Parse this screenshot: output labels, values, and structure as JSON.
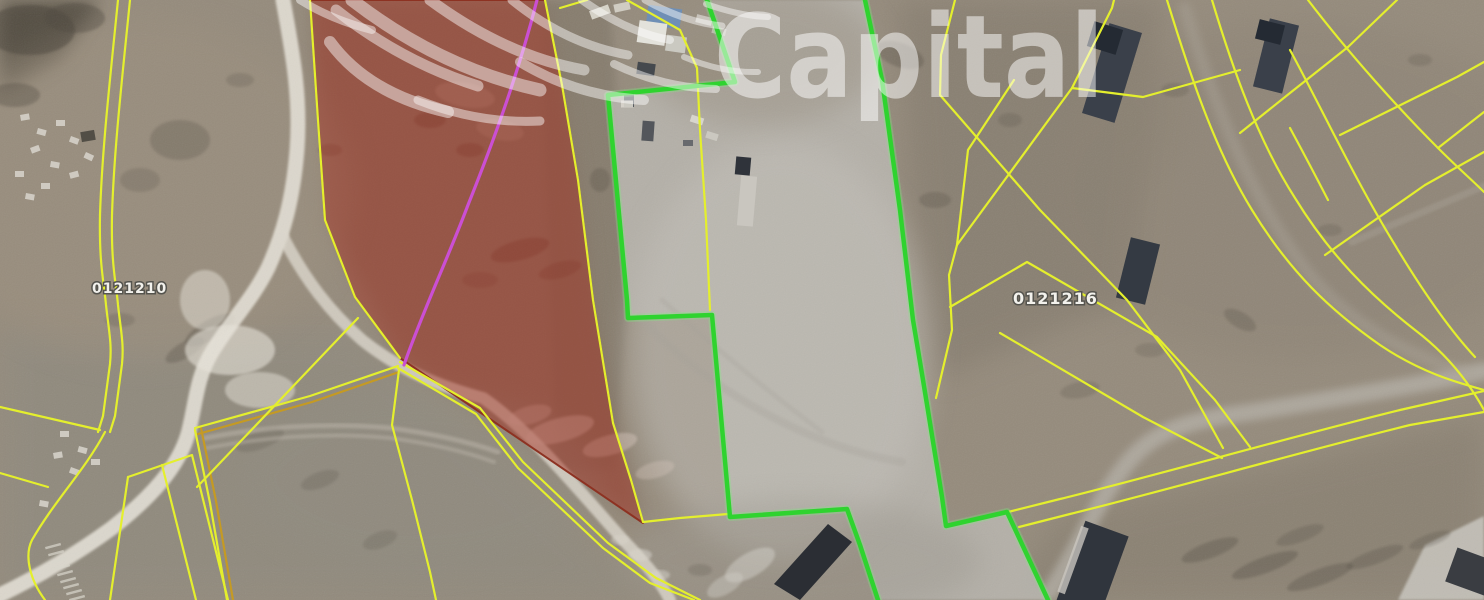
{
  "watermark": {
    "text": "Capital"
  },
  "labels": {
    "parcel_left": "0121210",
    "parcel_right": "0121216"
  },
  "colors": {
    "parcel_line_yellow": "#e4ef2d",
    "parcel_line_orange": "#c59a23",
    "selected_parcel_green": "#2fd32f",
    "selected_parcel_glow": "#7ef07e",
    "highlight_red_fill": "rgba(163,44,30,0.47)",
    "highlight_red_border": "#8d3222",
    "survey_line_magenta": "#cb4fd3",
    "road_light": "#e9e5db",
    "terrain_base": "#958b7c",
    "concrete_pad": "#b9b6af",
    "watermark_white": "rgba(255,255,255,0.55)"
  },
  "map": {
    "base": {
      "w": 1484,
      "h": 600,
      "fill": "#958b7c"
    },
    "patches": [
      {
        "pts": "0,0 100,0 62,58 0,95",
        "c": "#4f483c",
        "o": 0.8,
        "f": "b10"
      },
      {
        "pts": "0,330 360,330 660,600 0,600",
        "c": "#8e8a7f",
        "o": 0.6,
        "f": "b16"
      },
      {
        "pts": "540,0 610,0 628,300 614,470 556,470",
        "c": "#7e7566",
        "o": 0.6,
        "f": "b5"
      },
      {
        "pts": "898,0 1162,0 1130,300 938,378 918,300",
        "c": "#7f7669",
        "o": 0.5,
        "f": "b16"
      },
      {
        "pts": "1000,600 1062,518 1484,418 1484,600",
        "c": "#847b6d",
        "o": 0.55,
        "f": "b16"
      },
      {
        "pts": "310,0 545,0 578,180 593,300 643,523 400,358 325,220",
        "c": "#83705f",
        "o": 0.6,
        "f": "b10"
      },
      {
        "pts": "1398,600 1425,545 1484,516 1484,600",
        "c": "#c6c3bb",
        "o": 0.9,
        "f": "b2"
      }
    ],
    "pad_fill": [
      {
        "d": "M707,0 L865,0 L882,80 L900,210 L913,320 L923,380 L942,497 L946,526 L1007,512 L1048,600 L878,600 L860,545 L847,509 L730,517 L712,315 L628,318 L627,300 L608,95 L735,82 Z",
        "f": "#b9b6af",
        "o": 0.88
      }
    ],
    "soft_spots": [
      [
        140,
        190,
        210,
        170,
        0,
        "#9b8f7e",
        0.5
      ],
      [
        780,
        350,
        150,
        210,
        0,
        "#c3c0b9",
        0.5
      ],
      [
        760,
        55,
        120,
        70,
        0,
        "#9a9183",
        0.5
      ],
      [
        1300,
        190,
        260,
        170,
        0,
        "#8b8173",
        0.4
      ],
      [
        800,
        560,
        180,
        60,
        0,
        "#9c988f",
        0.45
      ],
      [
        420,
        480,
        180,
        90,
        0,
        "#908c81",
        0.4
      ],
      [
        1090,
        120,
        90,
        70,
        0,
        "#8a8172",
        0.35
      ]
    ],
    "dark_spots": [
      [
        30,
        30,
        45,
        25,
        0,
        "#4d463c",
        0.55
      ],
      [
        75,
        18,
        30,
        15,
        0,
        "#4d463c",
        0.4
      ],
      [
        15,
        95,
        25,
        12,
        0,
        "#4d463c",
        0.35
      ],
      [
        180,
        140,
        30,
        20,
        0,
        "#4d463c",
        0.25
      ],
      [
        140,
        180,
        20,
        12,
        0,
        "#4d463c",
        0.2
      ],
      [
        120,
        320,
        15,
        7,
        0,
        "#4d463c",
        0.2
      ],
      [
        210,
        330,
        28,
        10,
        -30,
        "#4d463c",
        0.35
      ],
      [
        185,
        350,
        22,
        8,
        -30,
        "#4d463c",
        0.3
      ],
      [
        240,
        80,
        14,
        7,
        0,
        "#4d463c",
        0.2
      ],
      [
        330,
        150,
        12,
        6,
        0,
        "#5a3227",
        0.22
      ],
      [
        430,
        120,
        16,
        8,
        0,
        "#5a3227",
        0.3
      ],
      [
        470,
        150,
        14,
        7,
        0,
        "#5a3227",
        0.28
      ],
      [
        520,
        250,
        30,
        10,
        -15,
        "#5f352a",
        0.32
      ],
      [
        560,
        270,
        22,
        8,
        -15,
        "#5f352a",
        0.25
      ],
      [
        480,
        280,
        18,
        8,
        0,
        "#5f352a",
        0.2
      ],
      [
        600,
        180,
        10,
        12,
        0,
        "#4a4238",
        0.25
      ],
      [
        900,
        55,
        25,
        12,
        20,
        "#4d463c",
        0.3
      ],
      [
        935,
        200,
        16,
        8,
        0,
        "#4d463c",
        0.25
      ],
      [
        1010,
        120,
        12,
        7,
        0,
        "#4d463c",
        0.2
      ],
      [
        1175,
        90,
        14,
        7,
        0,
        "#4d463c",
        0.2
      ],
      [
        1240,
        320,
        18,
        8,
        30,
        "#4d463c",
        0.25
      ],
      [
        1330,
        230,
        12,
        6,
        0,
        "#4d463c",
        0.2
      ],
      [
        1420,
        60,
        12,
        6,
        0,
        "#4d463c",
        0.2
      ],
      [
        1210,
        550,
        30,
        8,
        -20,
        "#4f4a40",
        0.32
      ],
      [
        1265,
        565,
        35,
        8,
        -20,
        "#4f4a40",
        0.34
      ],
      [
        1320,
        577,
        35,
        8,
        -20,
        "#4f4a40",
        0.32
      ],
      [
        1375,
        557,
        30,
        7,
        -20,
        "#4f4a40",
        0.28
      ],
      [
        1300,
        535,
        25,
        7,
        -20,
        "#4f4a40",
        0.25
      ],
      [
        1430,
        540,
        22,
        6,
        -20,
        "#4f4a40",
        0.25
      ],
      [
        700,
        570,
        12,
        6,
        0,
        "#4d463c",
        0.2
      ],
      [
        260,
        440,
        25,
        9,
        -20,
        "#4d463c",
        0.2
      ],
      [
        320,
        480,
        20,
        8,
        -20,
        "#4d463c",
        0.2
      ],
      [
        380,
        540,
        18,
        8,
        -20,
        "#4d463c",
        0.18
      ],
      [
        1080,
        390,
        20,
        8,
        -10,
        "#4d463c",
        0.2
      ],
      [
        1150,
        350,
        15,
        7,
        0,
        "#4d463c",
        0.18
      ]
    ],
    "light_spots": [
      [
        560,
        430,
        35,
        12,
        -15,
        "#d9c9bf",
        0.5
      ],
      [
        610,
        445,
        28,
        10,
        -15,
        "#d9c9bf",
        0.45
      ],
      [
        530,
        415,
        22,
        9,
        -15,
        "#d9c9bf",
        0.4
      ],
      [
        655,
        470,
        20,
        8,
        -15,
        "#d9c9bf",
        0.35
      ],
      [
        750,
        565,
        28,
        12,
        -30,
        "#cfccc4",
        0.55
      ],
      [
        725,
        585,
        20,
        9,
        -30,
        "#cfccc4",
        0.45
      ],
      [
        640,
        555,
        12,
        6,
        0,
        "#dcd9d1",
        0.5
      ],
      [
        660,
        575,
        10,
        5,
        0,
        "#dcd9d1",
        0.45
      ],
      [
        620,
        540,
        9,
        5,
        0,
        "#dcd9d1",
        0.4
      ],
      [
        230,
        350,
        45,
        25,
        0,
        "#e8e4da",
        0.6
      ],
      [
        260,
        390,
        35,
        18,
        0,
        "#e8e4da",
        0.5
      ],
      [
        205,
        300,
        25,
        30,
        0,
        "#e8e4da",
        0.5
      ],
      [
        465,
        95,
        30,
        12,
        10,
        "#b9a696",
        0.4
      ],
      [
        500,
        130,
        24,
        10,
        10,
        "#b9a696",
        0.35
      ]
    ],
    "roads": [
      {
        "d": "M283,0 C292,50 301,95 297,150 C293,200 283,235 268,268 C252,300 230,322 212,352 C196,378 196,404 188,434 C178,468 150,498 112,528 C75,555 35,578 0,595",
        "w": 15,
        "c": "#e9e5db",
        "o": 0.85,
        "f": "b2"
      },
      {
        "d": "M282,235 C305,280 330,312 362,340 C402,372 445,388 483,398 C530,430 580,492 625,542 C650,568 662,584 670,600",
        "w": 12,
        "c": "#ddd8cd",
        "o": 0.8,
        "f": "b2"
      },
      {
        "d": "M1050,592 C1075,555 1095,505 1122,470 C1152,428 1192,420 1252,412 C1332,399 1420,385 1484,371",
        "w": 17,
        "c": "#b7b3aa",
        "o": 0.7,
        "f": "b5"
      },
      {
        "d": "M1185,8 C1215,110 1255,205 1310,275 C1355,330 1420,360 1470,374",
        "w": 12,
        "c": "#a9a296",
        "o": 0.45,
        "f": "b5"
      },
      {
        "d": "M1352,242 L1484,186",
        "w": 7,
        "c": "#a9a296",
        "o": 0.4,
        "f": "b2"
      },
      {
        "d": "M205,438 Q300,420 390,428 Q452,436 498,452",
        "w": 5,
        "c": "#bdb6aa",
        "o": 0.5,
        "f": "b2"
      },
      {
        "d": "M207,448 Q302,430 390,438 Q450,446 494,462",
        "w": 4,
        "c": "#bdb6aa",
        "o": 0.45,
        "f": "b2"
      },
      {
        "d": "M640,318 Q702,382 782,422 Q842,452 902,462",
        "w": 8,
        "c": "#a5a199",
        "o": 0.3,
        "f": "b2"
      },
      {
        "d": "M662,300 Q742,372 822,432",
        "w": 5,
        "c": "#a5a199",
        "o": 0.28,
        "f": "b2"
      }
    ],
    "buildings": [
      [
        1112,
        73,
        34,
        94,
        17,
        "#3a404a",
        1
      ],
      [
        1105,
        38,
        30,
        26,
        17,
        "#242a33",
        1
      ],
      [
        1276,
        56,
        30,
        70,
        14,
        "#3a404a",
        1
      ],
      [
        1270,
        32,
        26,
        20,
        14,
        "#242a33",
        1
      ],
      [
        1138,
        271,
        30,
        62,
        14,
        "#343a43",
        1
      ],
      [
        1092,
        570,
        46,
        88,
        20,
        "#30353d",
        1
      ],
      [
        1073,
        560,
        8,
        70,
        20,
        "#c9c6bf",
        0.8
      ],
      [
        1472,
        572,
        44,
        36,
        20,
        "#3a3d42",
        1
      ],
      [
        664,
        17,
        34,
        20,
        8,
        "#6f8fb5",
        1
      ],
      [
        652,
        33,
        28,
        22,
        8,
        "#e3e2db",
        1
      ],
      [
        676,
        44,
        20,
        16,
        8,
        "#cfcfc8",
        0.9
      ],
      [
        743,
        166,
        15,
        18,
        5,
        "#2f333a",
        1
      ],
      [
        747,
        201,
        16,
        50,
        5,
        "#c9c6bf",
        1
      ],
      [
        600,
        12,
        20,
        9,
        -20,
        "#dedbd2",
        0.9
      ],
      [
        622,
        7,
        16,
        8,
        -12,
        "#d6d3ca",
        0.9
      ],
      [
        704,
        20,
        16,
        8,
        14,
        "#d0cdc5",
        0.85
      ],
      [
        719,
        31,
        14,
        7,
        14,
        "#c8c5bd",
        0.8
      ],
      [
        646,
        69,
        18,
        12,
        8,
        "#3c4148",
        0.9
      ],
      [
        629,
        99,
        10,
        16,
        0,
        "#474c52",
        0.85
      ],
      [
        648,
        131,
        12,
        20,
        4,
        "#42474e",
        0.85
      ],
      [
        627,
        104,
        12,
        7,
        0,
        "#d8d5cc",
        0.9
      ],
      [
        697,
        120,
        13,
        7,
        18,
        "#dcd9d1",
        0.9
      ],
      [
        712,
        136,
        12,
        7,
        18,
        "#cfccc4",
        0.85
      ],
      [
        688,
        143,
        10,
        6,
        0,
        "#55595f",
        0.8
      ],
      [
        88,
        136,
        14,
        10,
        -10,
        "#4a473f",
        0.9
      ]
    ],
    "building_polys": [
      {
        "pts": "828,524 852,542 800,600 774,584",
        "c": "#2b2e34",
        "o": 1
      }
    ],
    "debris": [
      [
        20,
        115,
        -10
      ],
      [
        38,
        128,
        15
      ],
      [
        56,
        120,
        0
      ],
      [
        71,
        136,
        20
      ],
      [
        30,
        148,
        -20
      ],
      [
        51,
        161,
        10
      ],
      [
        15,
        171,
        0
      ],
      [
        69,
        173,
        -15
      ],
      [
        86,
        152,
        25
      ],
      [
        41,
        183,
        0
      ],
      [
        26,
        193,
        10
      ],
      [
        60,
        431,
        0
      ],
      [
        79,
        446,
        15
      ],
      [
        53,
        453,
        -10
      ],
      [
        91,
        459,
        0
      ],
      [
        71,
        467,
        20
      ],
      [
        117,
        519,
        0
      ],
      [
        40,
        500,
        10
      ]
    ],
    "ladder_dashes": [
      [
        45,
        547
      ],
      [
        48,
        554
      ],
      [
        51,
        561
      ],
      [
        54,
        568
      ],
      [
        57,
        574
      ],
      [
        60,
        581
      ],
      [
        63,
        587
      ],
      [
        66,
        593
      ],
      [
        69,
        599
      ]
    ],
    "parcel_lines": [
      {
        "d": "M118,0 C110,80 102,150 100,215 C99,265 104,282 106,305 C109,332 112,344 110,364 L103,416 L98,432"
      },
      {
        "d": "M130,0 C122,80 114,150 112,215 C111,265 116,282 118,305 C121,332 124,344 122,364 L115,416 L110,432"
      },
      {
        "d": "M105,432 C85,470 55,500 32,540 C24,556 30,580 45,600"
      },
      {
        "d": "M0,407 L100,430"
      },
      {
        "d": "M0,473 L48,487"
      },
      {
        "d": "M128,477 L192,455 L228,600"
      },
      {
        "d": "M128,477 L110,600"
      },
      {
        "d": "M162,465 L196,600"
      },
      {
        "d": "M195,430 L210,503 L227,600"
      },
      {
        "d": "M201,428 L216,501 L233,600",
        "c": "#c59a23"
      },
      {
        "d": "M398,366 L310,396 L195,428"
      },
      {
        "d": "M399,372 L312,402 L198,434",
        "c": "#c59a23"
      },
      {
        "d": "M358,318 L280,400 L197,487"
      },
      {
        "d": "M399,370 L392,425 L412,500 L430,572 L436,600"
      },
      {
        "d": "M400,362 L480,408 L523,462 L608,543 L656,578 L700,600"
      },
      {
        "d": "M398,368 L476,414 L518,468 L603,548 L650,583 L694,600"
      },
      {
        "d": "M310,0 L318,120 L325,220 L355,297 L400,358"
      },
      {
        "d": "M545,0 L562,85 L578,180 L593,300 L613,423 L631,480 L643,522 L680,518 L728,514"
      },
      {
        "d": "M627,0 L680,30 L697,68 L700,130 L706,220 L710,310"
      },
      {
        "d": "M560,8 L587,0"
      },
      {
        "d": "M955,0 L941,55 L940,95"
      },
      {
        "d": "M940,95 L1040,210 L1127,300 L1180,370 L1223,448"
      },
      {
        "d": "M957,245 L1072,88 L1112,8 L1114,0"
      },
      {
        "d": "M1072,88 L1143,97 L1240,70"
      },
      {
        "d": "M957,245 L968,150 L1014,80"
      },
      {
        "d": "M957,245 L949,275 L952,330 L936,398"
      },
      {
        "d": "M950,307 L1027,262 L1157,337 L1215,400 L1250,447"
      },
      {
        "d": "M1000,333 L1143,417 L1222,458"
      },
      {
        "d": "M1167,0 C1190,75 1215,150 1252,210 C1290,272 1330,310 1380,345 C1420,372 1455,382 1484,390"
      },
      {
        "d": "M1212,0 C1233,70 1258,140 1295,198 C1330,255 1370,295 1415,330 C1452,358 1472,388 1484,410"
      },
      {
        "d": "M1008,512 L1060,499 C1150,477 1290,437 1400,410 L1484,391"
      },
      {
        "d": "M1019,527 L1070,514 C1160,492 1300,452 1410,425 L1484,412"
      },
      {
        "d": "M1240,133 L1290,93 L1348,47"
      },
      {
        "d": "M1348,47 L1397,0"
      },
      {
        "d": "M1308,0 C1350,55 1400,110 1438,148 C1458,168 1472,180 1484,192"
      },
      {
        "d": "M1340,135 L1457,77 L1484,62"
      },
      {
        "d": "M1438,148 L1484,112"
      },
      {
        "d": "M1290,50 C1320,105 1355,180 1395,245 C1425,295 1450,330 1475,357"
      },
      {
        "d": "M1325,255 L1425,185 L1484,152"
      },
      {
        "d": "M1290,128 Q1310,165 1328,200"
      }
    ],
    "red_overlay": [
      {
        "d": "M310,0 L545,0 L562,85 L578,180 L593,300 L613,423 L631,480 L643,523 L400,358 L355,297 L325,220 Z",
        "f": "rgba(163,44,30,0.47)",
        "c": "#8d3222",
        "w": 2
      }
    ],
    "magenta_line": [
      {
        "d": "M537,0 C518,75 492,145 468,205 C448,258 420,318 404,365",
        "c": "#cb4fd3",
        "w": 3.2
      }
    ],
    "green_outline": [
      {
        "d": "M707,0 L735,82 L608,95 L627,300 L628,318 L712,315 L730,517 L847,509 L860,545 L878,600",
        "c": "#7ef07e",
        "w": 8,
        "o": 0.3
      },
      {
        "d": "M865,0 L882,80 L900,210 L913,320 L923,380 L942,497 L946,526 L1007,512 L1048,600",
        "c": "#7ef07e",
        "w": 8,
        "o": 0.3
      },
      {
        "d": "M707,0 L735,82 L608,95 L627,300 L628,318 L712,315 L730,517 L847,509 L860,545 L878,600",
        "c": "#2fd32f",
        "w": 4.5
      },
      {
        "d": "M865,0 L882,80 L900,210 L913,320 L923,380 L942,497 L946,526 L1007,512 L1048,600",
        "c": "#2fd32f",
        "w": 4.5
      }
    ],
    "logo_arcs": [
      {
        "d": "M300,0 Q332,20 372,30",
        "w": 8
      },
      {
        "d": "M336,10 Q402,62 478,86",
        "w": 11
      },
      {
        "d": "M352,0 Q440,68 540,90",
        "w": 13
      },
      {
        "d": "M330,42 Q368,94 448,112",
        "w": 12
      },
      {
        "d": "M430,0 Q506,56 584,70",
        "w": 11
      },
      {
        "d": "M512,0 Q566,44 628,55",
        "w": 9
      },
      {
        "d": "M582,0 Q626,32 670,40",
        "w": 8
      },
      {
        "d": "M645,0 Q684,22 722,26",
        "w": 7
      },
      {
        "d": "M706,4 Q740,16 768,17",
        "w": 6
      },
      {
        "d": "M520,62 Q576,96 644,100",
        "w": 10
      },
      {
        "d": "M614,64 Q664,88 716,89",
        "w": 8
      },
      {
        "d": "M684,57 Q722,73 758,72",
        "w": 6
      },
      {
        "d": "M418,100 Q478,124 540,121",
        "w": 9
      }
    ]
  }
}
